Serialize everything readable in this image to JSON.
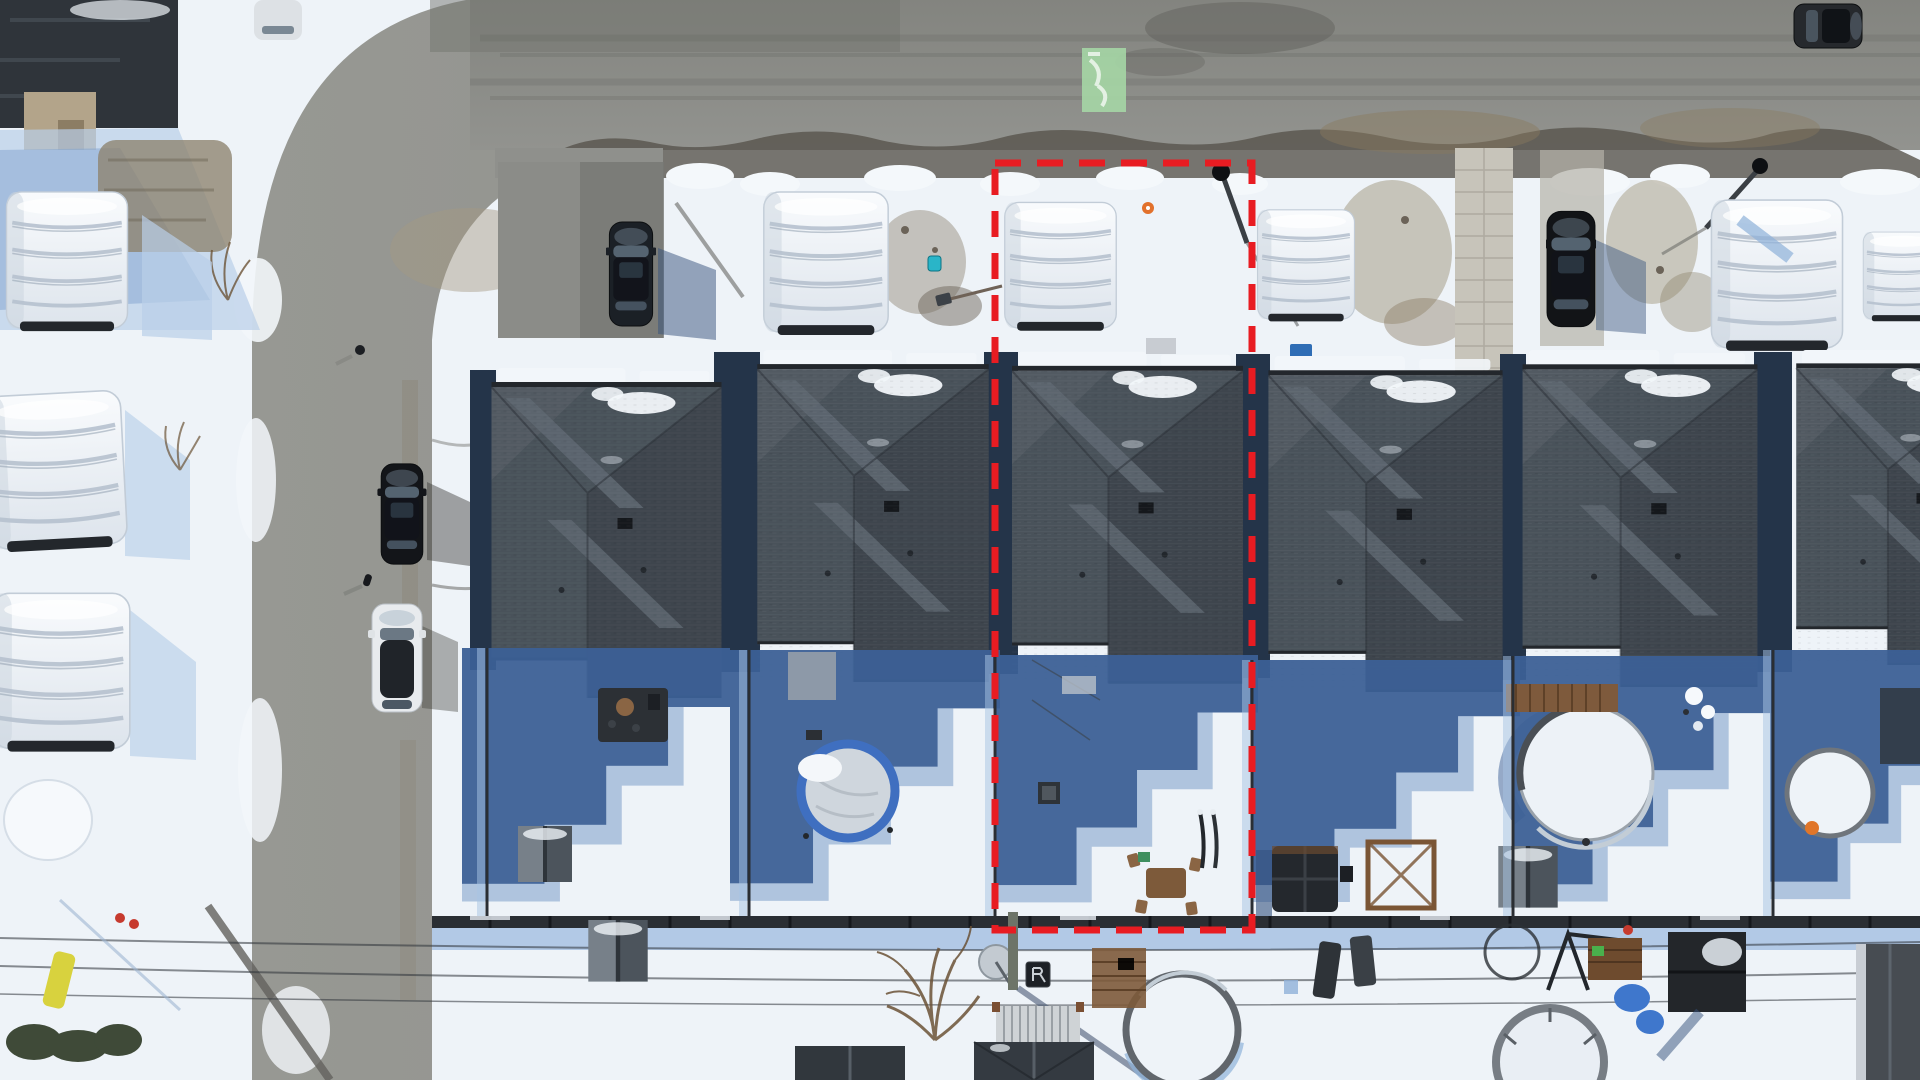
{
  "scene": {
    "type": "aerial-drone-photo",
    "view": "top-down",
    "season": "winter",
    "subject": "Snow-covered suburban street; one residential lot outlined with a red dashed property boundary"
  },
  "annotation": {
    "label": "highlighted-property-boundary",
    "x": 995,
    "y": 163,
    "width": 257,
    "height": 767,
    "color": "#e81c22",
    "stroke_width": 7,
    "dash": "26 16"
  },
  "road_marking": {
    "label": "green-paint-utility-mark",
    "x": 1082,
    "y": 48,
    "width": 44,
    "height": 64,
    "color": "#a5d6a5"
  },
  "palette": {
    "snow": "#eef3f8",
    "snowShadow": "#b9cfe8",
    "deepShadow": "#3c6096",
    "midShadow": "#7b9cc9",
    "asphalt": "#8f908c",
    "asphaltDark": "#6e6e6a",
    "dirt": "#9b8d74",
    "roof": "#49525a",
    "roofDark": "#343b43",
    "roofLight": "#5d6670",
    "fascia": "#23272c",
    "tarp": "#f2f5f8",
    "tarpShade": "#b6c1ce",
    "fence": "#2a2e33",
    "wood": "#8a6544",
    "poolRim": "#5a5f65",
    "blueTarp": "#3f77cc",
    "tealToy": "#2ab5c8"
  },
  "houses": [
    {
      "x": 490,
      "y": 368,
      "w": 233,
      "h": 330
    },
    {
      "x": 752,
      "y": 350,
      "w": 242,
      "h": 332
    },
    {
      "x": 1012,
      "y": 350,
      "w": 231,
      "h": 335
    },
    {
      "x": 1262,
      "y": 356,
      "w": 247,
      "h": 336
    },
    {
      "x": 1517,
      "y": 350,
      "w": 246,
      "h": 337
    },
    {
      "x": 1786,
      "y": 350,
      "w": 240,
      "h": 315
    }
  ],
  "inventory": {
    "front_row_houses": 6,
    "front_yard_car_shelters": 5,
    "left_column_car_shelters": 4,
    "parked_vehicles": [
      {
        "type": "suv",
        "color": "dark-navy",
        "location": "left-driveway"
      },
      {
        "type": "suv",
        "color": "black",
        "location": "street-left"
      },
      {
        "type": "sedan",
        "color": "white-black-roof",
        "location": "street-left"
      },
      {
        "type": "suv",
        "color": "black",
        "location": "right-driveway"
      },
      {
        "type": "suv",
        "color": "dark-grey",
        "location": "top-right-road"
      }
    ],
    "backyard_features": [
      "blue-ring-trampoline",
      "above-ground-pool",
      "hot-tub",
      "pergola-frame",
      "garden-sheds",
      "patio-furniture",
      "satellite-dish",
      "snow-covered-pools",
      "bare-tree",
      "power-lines"
    ]
  }
}
